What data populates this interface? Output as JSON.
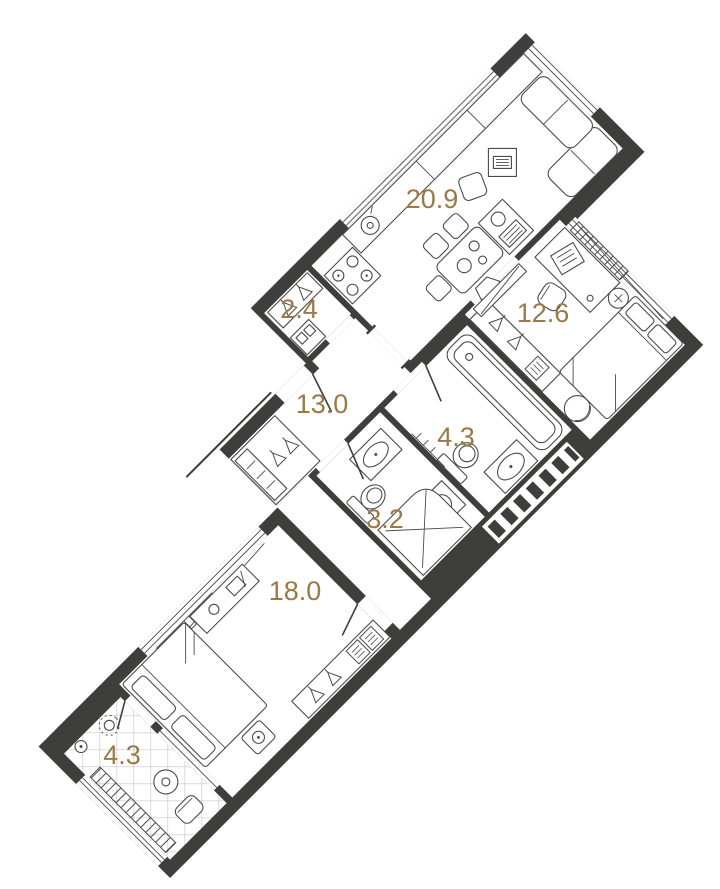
{
  "page": {
    "background": "#ffffff",
    "type": "apartment-floor-plan"
  },
  "colors": {
    "wall": "#3e3e3c",
    "area_label": "#9a7947",
    "furniture_line": "#4b4b4b",
    "tile_line": "#b8b8b8"
  },
  "floorplan": {
    "rotation_deg": -45,
    "rooms": [
      {
        "name": "kitchen-living-room",
        "area": "20.9",
        "fixtures": [
          "kitchen-counter",
          "sink",
          "stove",
          "dining-table",
          "chairs",
          "corner-sofa",
          "tv-stand",
          "island-unit",
          "windows",
          "radiator"
        ]
      },
      {
        "name": "bedroom-2",
        "area": "12.6",
        "fixtures": [
          "desk",
          "chair",
          "laptop",
          "single-bed",
          "armchair",
          "wardrobe",
          "radiator",
          "window"
        ]
      },
      {
        "name": "entry-hall",
        "area": "2.4",
        "fixtures": [
          "wardrobe",
          "shoe-cabinet"
        ]
      },
      {
        "name": "corridor",
        "area": "13.0",
        "fixtures": [
          "wardrobe",
          "drawer-unit",
          "entrance-door"
        ]
      },
      {
        "name": "bathroom",
        "area": "4.3",
        "fixtures": [
          "bathtub",
          "washbasin",
          "toilet",
          "towel-radiator"
        ]
      },
      {
        "name": "shower-wc",
        "area": "3.2",
        "fixtures": [
          "shower-cabin",
          "washbasin",
          "toilet",
          "washing-machine"
        ]
      },
      {
        "name": "bedroom-1",
        "area": "18.0",
        "fixtures": [
          "double-bed",
          "bedside-table",
          "desk",
          "wardrobe",
          "radiator",
          "window"
        ]
      },
      {
        "name": "loggia",
        "area": "4.3",
        "fixtures": [
          "tiled-floor",
          "plant",
          "round-table",
          "chair",
          "radiator-grate"
        ]
      }
    ]
  }
}
